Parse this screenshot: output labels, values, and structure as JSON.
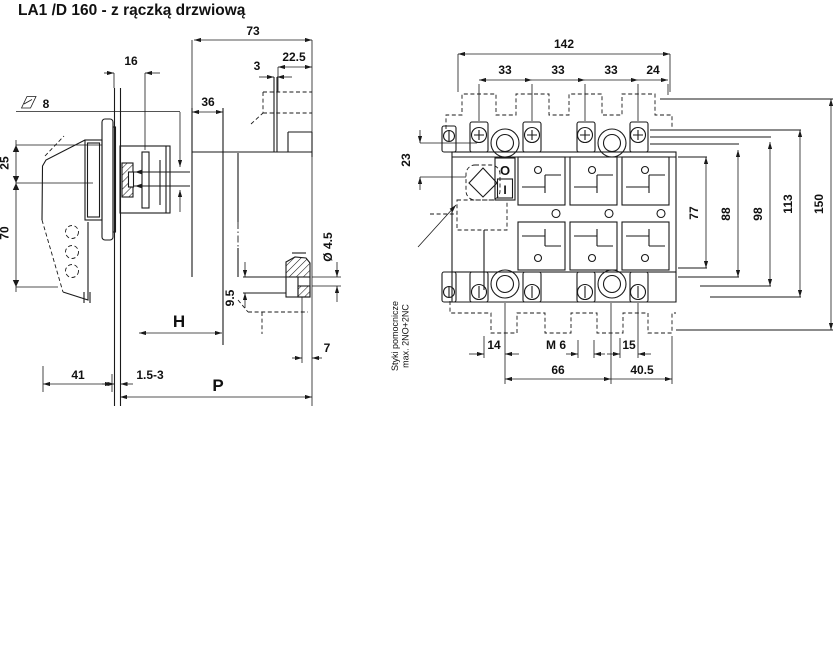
{
  "title": "LA1 /D 160 - z rączką drzwiową",
  "colors": {
    "ink": "#1a1a1a",
    "background": "#ffffff"
  },
  "side_view": {
    "dims": {
      "depth_total": "73",
      "flange_depth": "22.5",
      "bracket_thickness": "3",
      "shaft_16": "16",
      "body_depth": "36",
      "shaft_square": "8",
      "offset_25": "25",
      "handle_length": "70",
      "handle_depth": "41",
      "door_thickness": "1.5-3",
      "shaft_length_label": "H",
      "total_depth_label": "P",
      "foot_offset": "9.5",
      "hole_diameter": "Ø 4.5",
      "foot_width": "7"
    }
  },
  "front_view": {
    "dims": {
      "width_total": "142",
      "pole_pitch_1": "33",
      "pole_pitch_2": "33",
      "pole_pitch_3": "33",
      "pitch_aux": "24",
      "handle_offset": "23",
      "h77": "77",
      "h88": "88",
      "h98": "98",
      "h113": "113",
      "h150": "150",
      "b14": "14",
      "mounting_thread": "M 6",
      "b15": "15",
      "b66": "66",
      "b40_5": "40.5"
    },
    "switch": {
      "off_marking": "O",
      "on_marking": "I"
    },
    "note_line1": "Styki pomocnicze",
    "note_line2": "max. 2NO+2NC"
  }
}
